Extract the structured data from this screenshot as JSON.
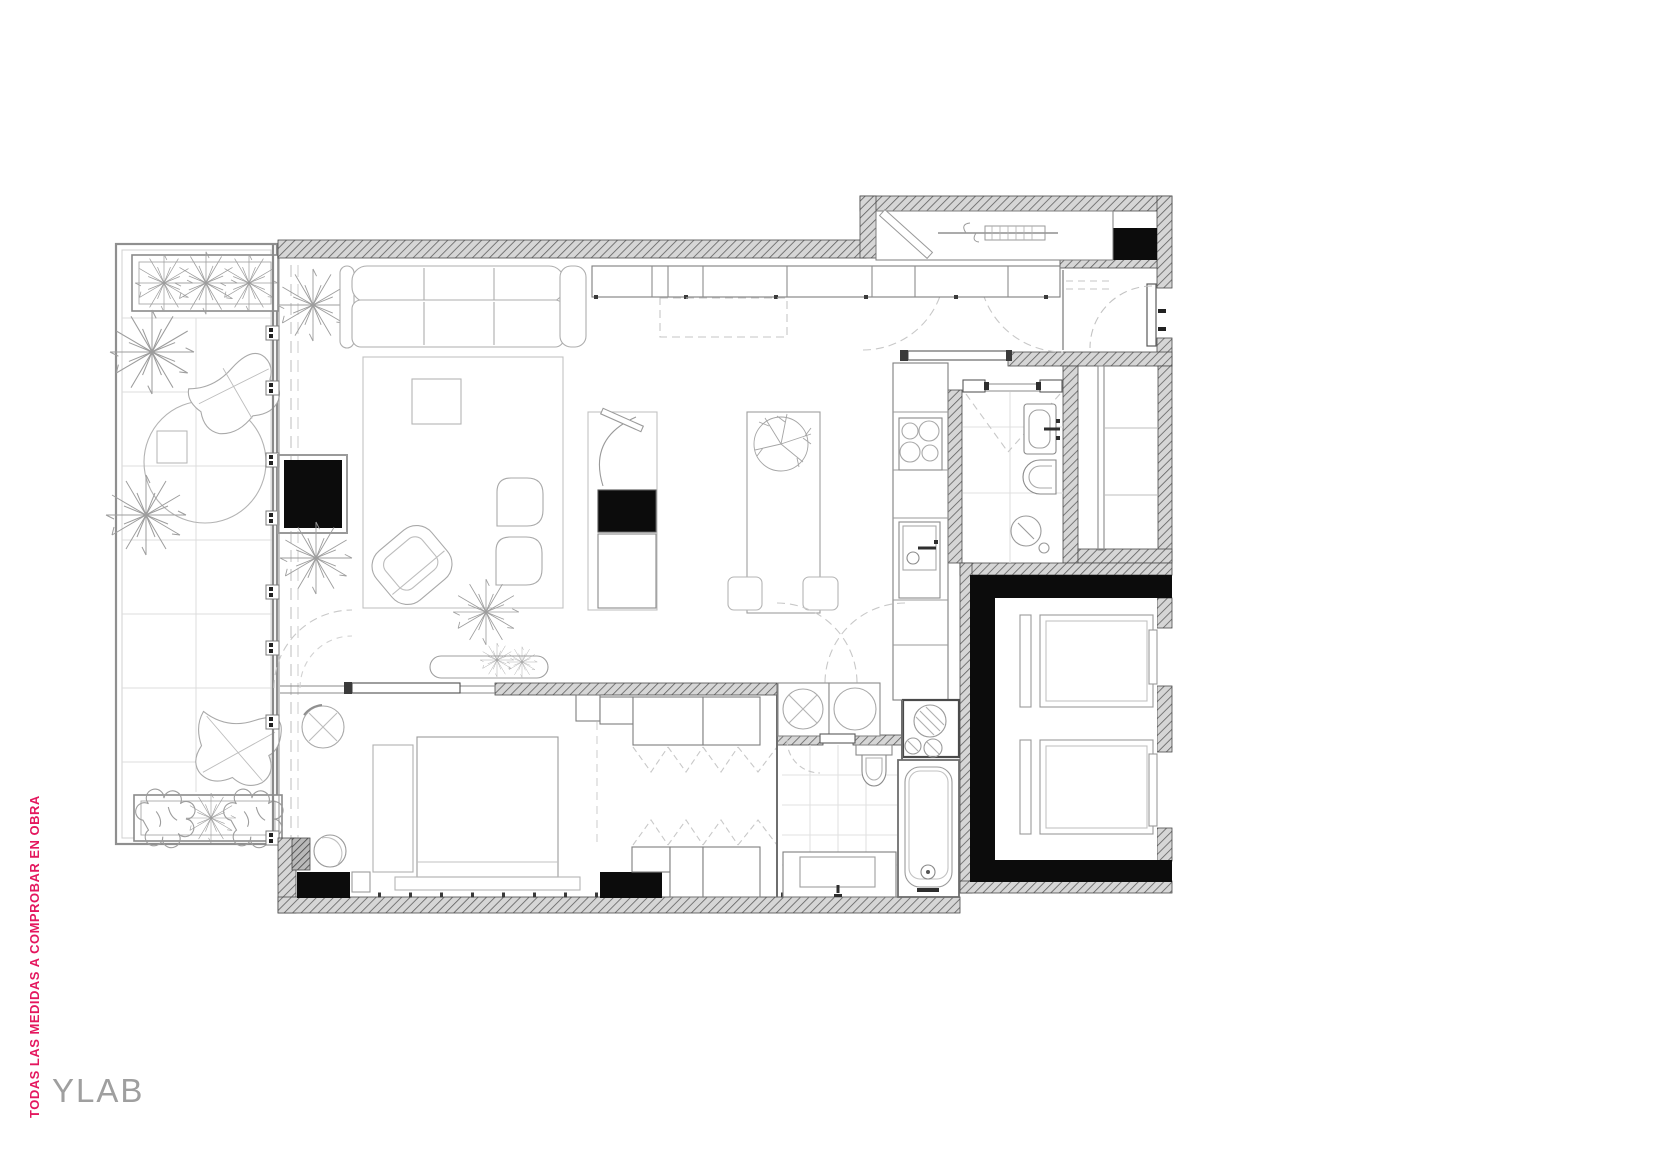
{
  "annotations": {
    "note": "TODAS LAS MEDIDAS A COMPROBAR EN OBRA",
    "logo": "YLAB"
  },
  "colors": {
    "note_pink": "#E4175E",
    "logo_gray": "#9F9F9F",
    "wall_black": "#0C0C0C",
    "wall_hatch_line": "#5F5F5F",
    "wall_hatch_bg": "#D4D4D4",
    "fixture_gray": "#7A7A7A",
    "furniture_gray": "#A9A9A9",
    "background": "#FFFFFF"
  },
  "drawing": {
    "type": "apartment floor plan"
  }
}
